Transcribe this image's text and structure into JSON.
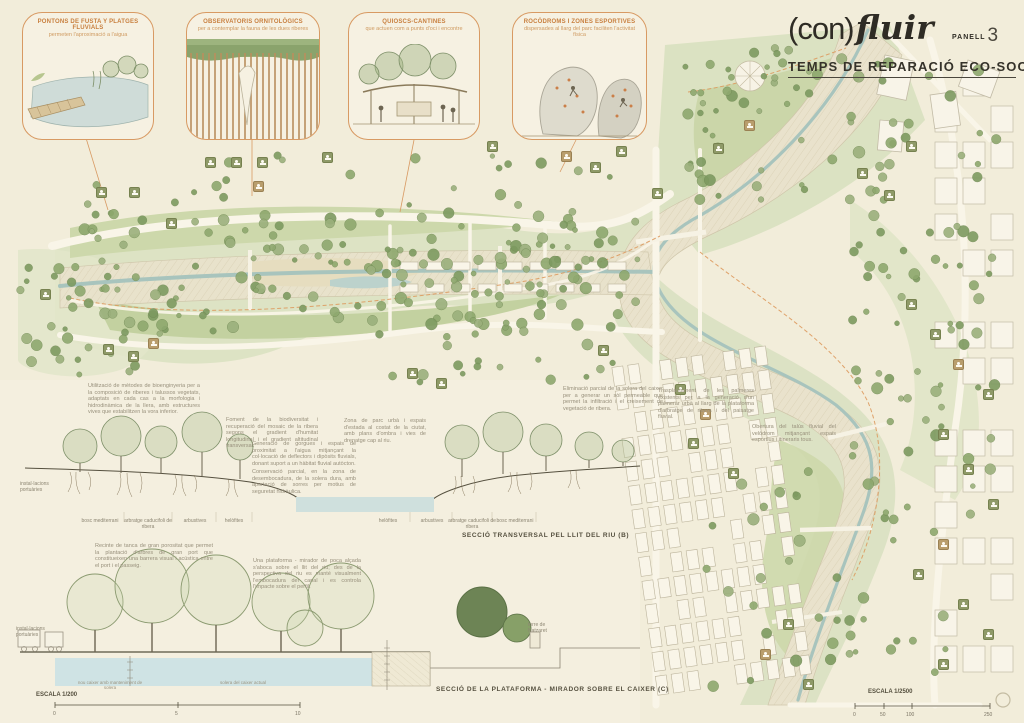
{
  "header": {
    "brand_prefix": "(con)",
    "brand_name": "fluir",
    "panel_label": "PANELL",
    "panel_number": "3",
    "subtitle": "TEMPS DE REPARACIÓ ECO-SOCIAL"
  },
  "vignettes": [
    {
      "title": "PONTONS DE FUSTA Y PLATGES FLUVIALS",
      "subtitle": "permeten l'aproximació a l'aigua"
    },
    {
      "title": "OBSERVATORIS ORNITOLÒGICS",
      "subtitle": "per a contemplar la fauna de les dues riberes"
    },
    {
      "title": "QUIOSCS-CANTINES",
      "subtitle": "que actuen com a punts d'oci i encontre"
    },
    {
      "title": "ROCÒDROMS I ZONES ESPORTIVES",
      "subtitle": "dispersades al llarg del parc faciliten l'activitat física"
    }
  ],
  "map": {
    "annotations": [
      {
        "text": "Utilització de mètodes de bioenginyeria per a la composició de riberes i talussos vegetats, adaptats en cada cas a la morfologia i hidrodinàmica de la llera, amb estructures vives que estabilitzen la vora inferior."
      },
      {
        "text": "Foment de la biodiversitat i recuperació del mosaic de la ribera segons el gradient d'humitat longitudinal i el gradient altitudinal transversal."
      },
      {
        "text": "Generació de gorgues i espais de proximitat a l'aigua mitjançant la col·locació de deflectors i dipòsits fluvials, donant suport a un hàbitat fluvial autòcton."
      },
      {
        "text": "Conservació parcial, en la zona de desembocadura, de la solera dura, amb aportació de sorres per motius de seguretat hidràulica."
      },
      {
        "text": "Zona de parc urbà i espais d'estada al costat de la ciutat, amb plans d'ombra i vies de drenatge cap al riu."
      },
      {
        "text": "Eliminació parcial de la solera del caixer per a generar un sòl permeable que permet la infiltració i el creixement de vegetació de ribera."
      },
      {
        "text": "Trasplantament de les palmeres existents per a la generació d'un palmerar urbà al llarg de la plataforma d'arbratge de ribera i del paisatge fluvial."
      },
      {
        "text": "Obertura del talús fluvial del velòdrom mitjançant espais esportius i itineraris tous."
      },
      {
        "text": "Recinte de tanca de gran porositat que permet la plantació d'arbres de gran port que constitueixen una barrera visual i acústica entre el port i el passeig."
      },
      {
        "text": "Una plataforma - mirador de poca alçada s'aboca sobre el llit del riu; des de la perspectiva del riu es manté visualment l'embocadura del canal i es controla l'impacte sobre el perfil."
      }
    ]
  },
  "sections": {
    "b": {
      "title": "SECCIÓ TRANSVERSAL PEL LLIT DEL RIU (B)",
      "labels_left": [
        "bosc mediterrani",
        "arbratge caducifoli de ribera",
        "arbustives",
        "helòfites"
      ],
      "labels_right": [
        "helòfites",
        "arbustives",
        "arbratge caducifoli de ribera",
        "bosc mediterrani"
      ],
      "edge_label": "instal·lacions portuàries"
    },
    "c": {
      "title": "SECCIÓ DE LA PLATAFORMA - MIRADOR SOBRE EL CAIXER (C)",
      "edge_label": "instal·lacions portuàries",
      "right_label": "torre de Natzaret",
      "note_left": "nou caixer amb manteniment de solera",
      "note_right": "solera del caixer actual"
    }
  },
  "scales": {
    "section": {
      "label": "ESCALA 1/200",
      "ticks": [
        "0",
        "5",
        "10"
      ]
    },
    "plan": {
      "label": "ESCALA 1/2500",
      "ticks": [
        "0",
        "50",
        "100",
        "250"
      ]
    }
  },
  "colors": {
    "paper": "#f2edda",
    "accent_orange": "#d89a63",
    "heading_orange": "#c87f3e",
    "park_green": "#c3d1a0",
    "tree_green": "#8ea86e",
    "riverbed": "#e9e2cc",
    "water": "#cfe0dd",
    "ink": "#4a463c"
  }
}
